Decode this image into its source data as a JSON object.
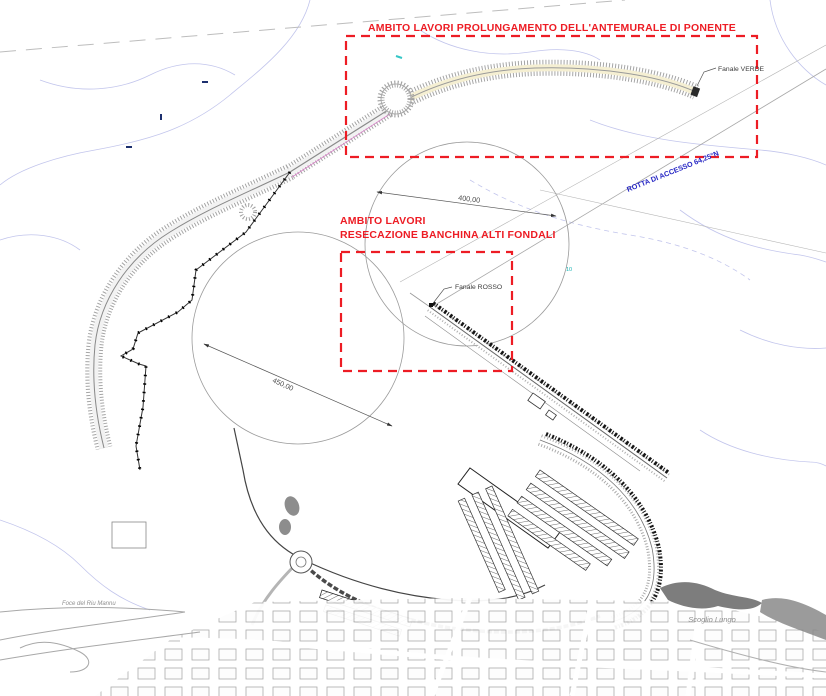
{
  "annotations": {
    "work_area_1": {
      "label": "AMBITO LAVORI PROLUNGAMENTO DELL'ANTEMURALE DI PONENTE"
    },
    "work_area_2": {
      "line1": "AMBITO LAVORI",
      "line2": "RESECAZIONE BANCHINA ALTI FONDALI"
    },
    "lights": {
      "green": "Fanale VERDE",
      "red": "Fanale ROSSO"
    },
    "route": {
      "label": "ROTTA DI ACCESSO 64,25°N"
    },
    "dimensions": {
      "basin_400": "400,00",
      "basin_450": "450,00"
    },
    "places": {
      "scoglio_lungo": "Scoglio Lungo",
      "river_mouth": "Foce del Riu Mannu"
    },
    "depth_mark": "10"
  },
  "colors": {
    "work_area_red": "#ed1c24",
    "route_blue": "#2727c4",
    "contour_lavender": "#c2c5ec",
    "breakwater_fill": "#f5efd2",
    "rock_dark": "#7d7d7d",
    "rubble_black": "#151515",
    "hatch_gray": "#a5a5a5"
  }
}
